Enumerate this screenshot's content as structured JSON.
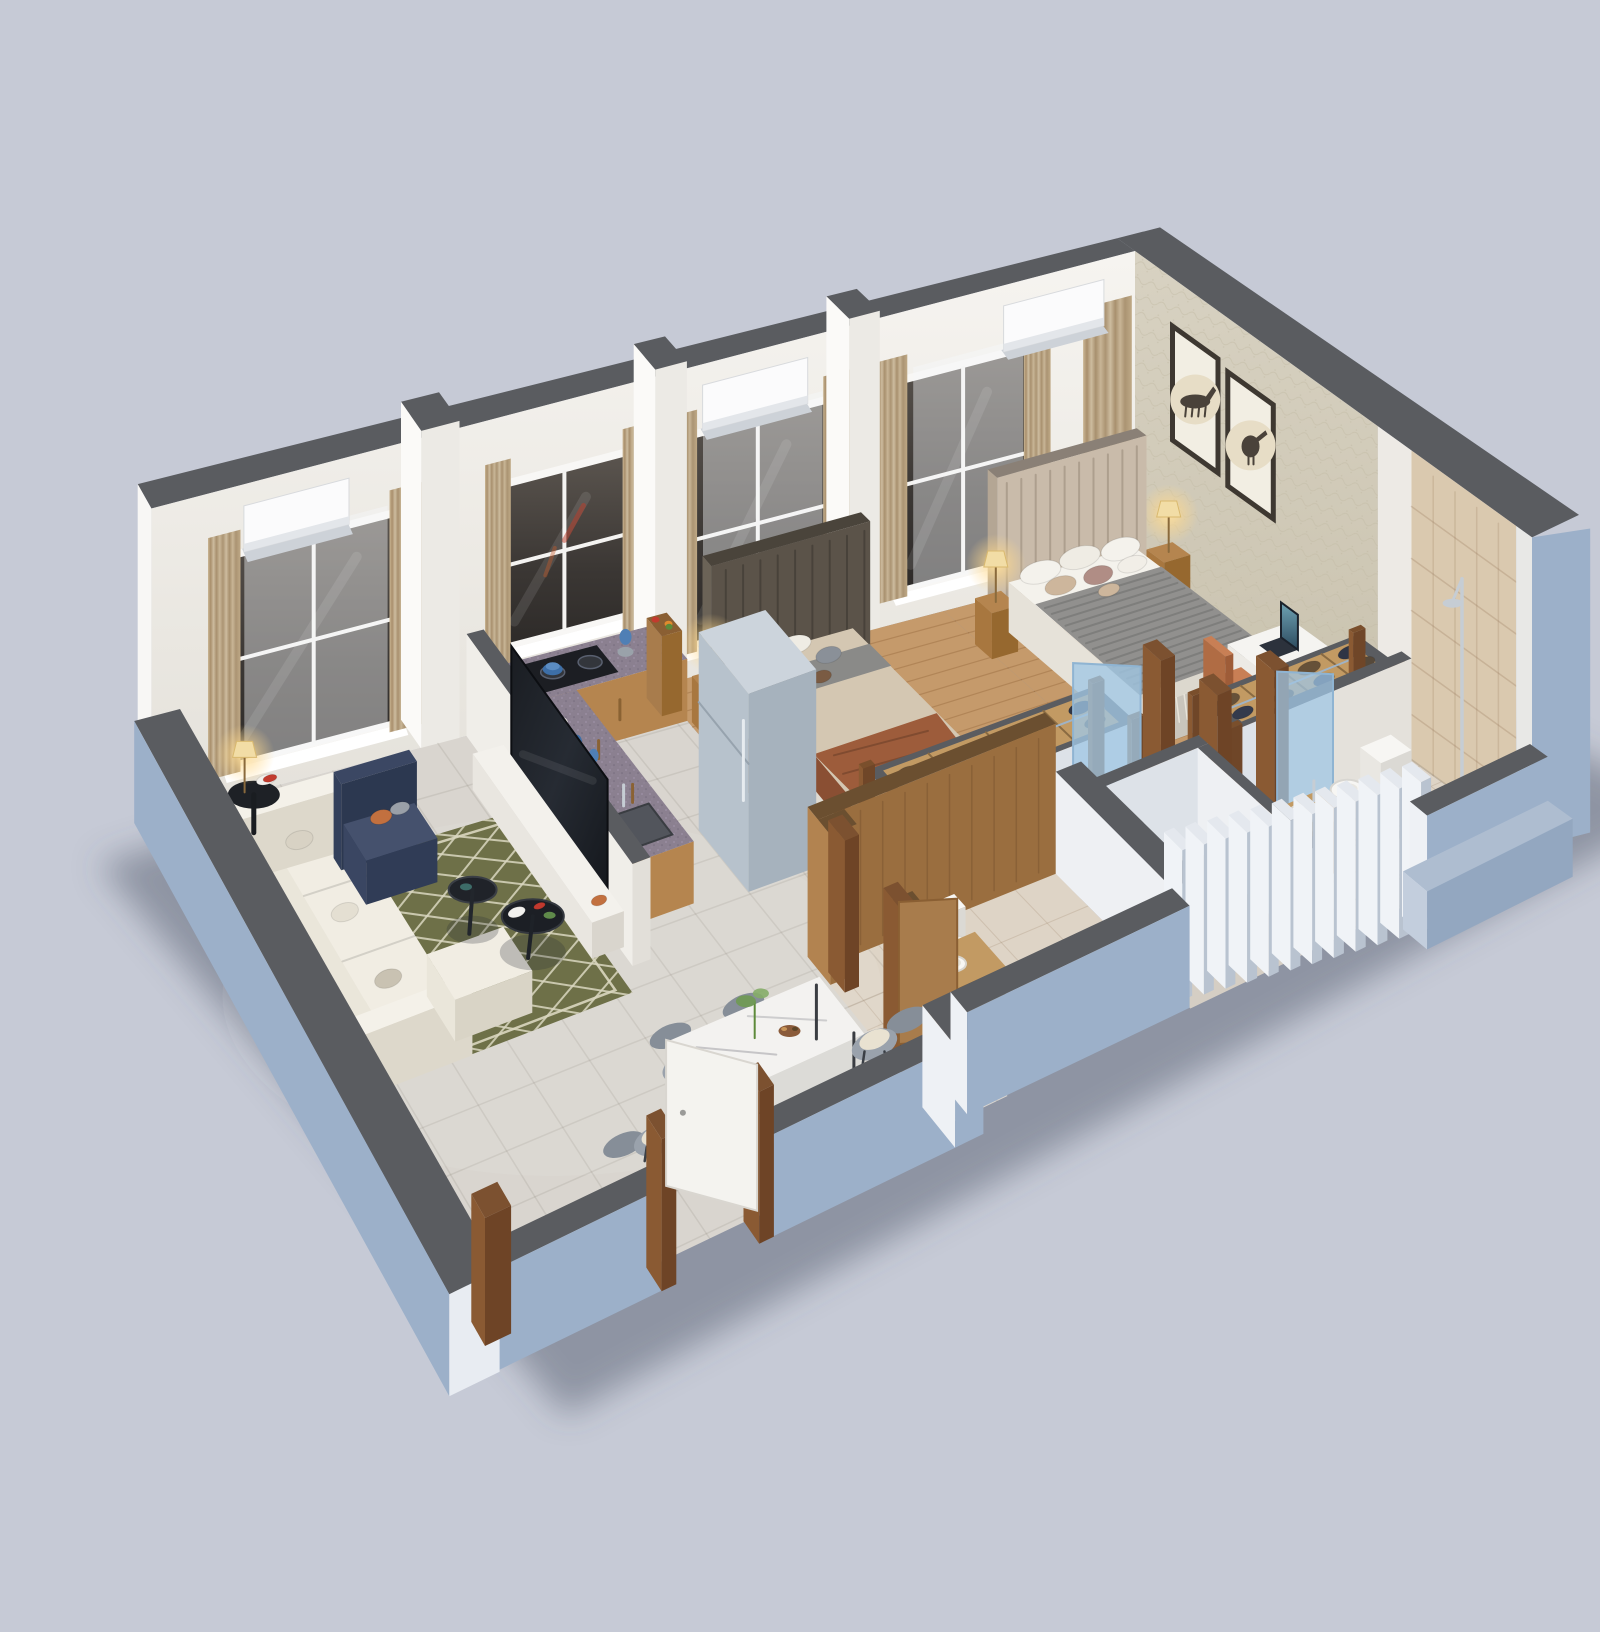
{
  "meta": {
    "type": "3d-floor-plan-render",
    "aria_label": "Isometric 3D rendered floor plan of a two-bedroom apartment with living room, kitchen, dining area, two bedrooms and two bathrooms"
  },
  "colors": {
    "bg": "#c6cad6",
    "shadow": "rgba(75,82,100,0.45)",
    "wall_top": "#5a5c60",
    "wall_outer": "#9cb0c9",
    "wall_outer_dark": "#8fa4bd",
    "wall_inner": "#f2efe9",
    "wall_inner_shade": "#e2dfd8",
    "wallpaper": "#d3ccba",
    "ne_tile": "#dac9af",
    "floor_marble": "#d9d5cf",
    "floor_wood": "#c59a6b",
    "floor_tile": "#ded4c6",
    "rug": "#6e7048",
    "rug_pattern": "#d9d6bf",
    "sofa": "#efebe0",
    "armchair_navy": "#35415c",
    "accent_orange": "#c2703f",
    "coffee_table": "#23262c",
    "dining_top": "#f3f2f0",
    "chair_gray": "#9aa2ac",
    "chair_cushion": "#e9e2d1",
    "granite": "#8b8090",
    "cabinet_wood": "#b5854f",
    "fridge": "#bec9d3",
    "bed_duvet": "#91908e",
    "bed_sheet": "#f4f2ec",
    "bed_tan": "#cdb69c",
    "throw_brown": "#9d5c3b",
    "headboard_tan": "#c9bbaa",
    "headboard_dark": "#5b5349",
    "bench_teal": "#31524c",
    "wardrobe_wood": "#c29a63",
    "clothes_dark": "#2f3545",
    "clothes_brown": "#665139",
    "lamp_glow": "#ffd98c",
    "art_frame": "#3e3831",
    "art_mat": "#f2eee3",
    "curtain_tan": "#bfa986",
    "glass_dark": "#46423f",
    "door_wood": "#8a5a33",
    "laminate": "#a87c4c",
    "desk_white": "#f5f4f1",
    "chair_terracotta": "#c07a52",
    "tv_black": "#15181d",
    "louver_light": "#e9edf2",
    "louver_side": "#bcc6d2",
    "chrome": "#c6cdd4",
    "toilet_white": "#f7f6f3"
  },
  "features": {
    "windows": 4,
    "ac_units": 3,
    "wall_art_frames": 2,
    "louver_fins": 12,
    "dining_seats": 6,
    "wardrobes": 2,
    "beds": 2,
    "bathrooms": 2
  },
  "rooms": [
    {
      "name": "living-room",
      "furniture": [
        "l-shaped-sofa",
        "navy-armchair",
        "coffee-tables",
        "patterned-rug",
        "side-table-lamp",
        "tv-console",
        "television"
      ]
    },
    {
      "name": "dining-area",
      "furniture": [
        "marble-dining-table",
        "dining-chairs",
        "plant-centerpiece"
      ]
    },
    {
      "name": "kitchen",
      "furniture": [
        "l-counter",
        "gas-stove",
        "sink",
        "refrigerator",
        "blender",
        "fruit-basket"
      ]
    },
    {
      "name": "bedroom-2",
      "furniture": [
        "double-bed",
        "dark-headboard",
        "nightstand-lamp",
        "open-wardrobe",
        "teal-bench"
      ]
    },
    {
      "name": "master-bedroom",
      "furniture": [
        "king-bed",
        "padded-headboard",
        "two-nightstand-lamps",
        "wall-art-frames",
        "desk-laptop",
        "terracotta-chair",
        "open-wardrobe"
      ]
    },
    {
      "name": "common-bathroom",
      "furniture": [
        "toilet",
        "wood-vanity-basin",
        "wood-partition"
      ]
    },
    {
      "name": "master-bathroom",
      "furniture": [
        "toilet",
        "wood-vanity-basin",
        "shower"
      ]
    },
    {
      "name": "hallway",
      "furniture": [
        "glass-door"
      ]
    },
    {
      "name": "utility-shaft",
      "furniture": [
        "louver-fins"
      ]
    }
  ]
}
